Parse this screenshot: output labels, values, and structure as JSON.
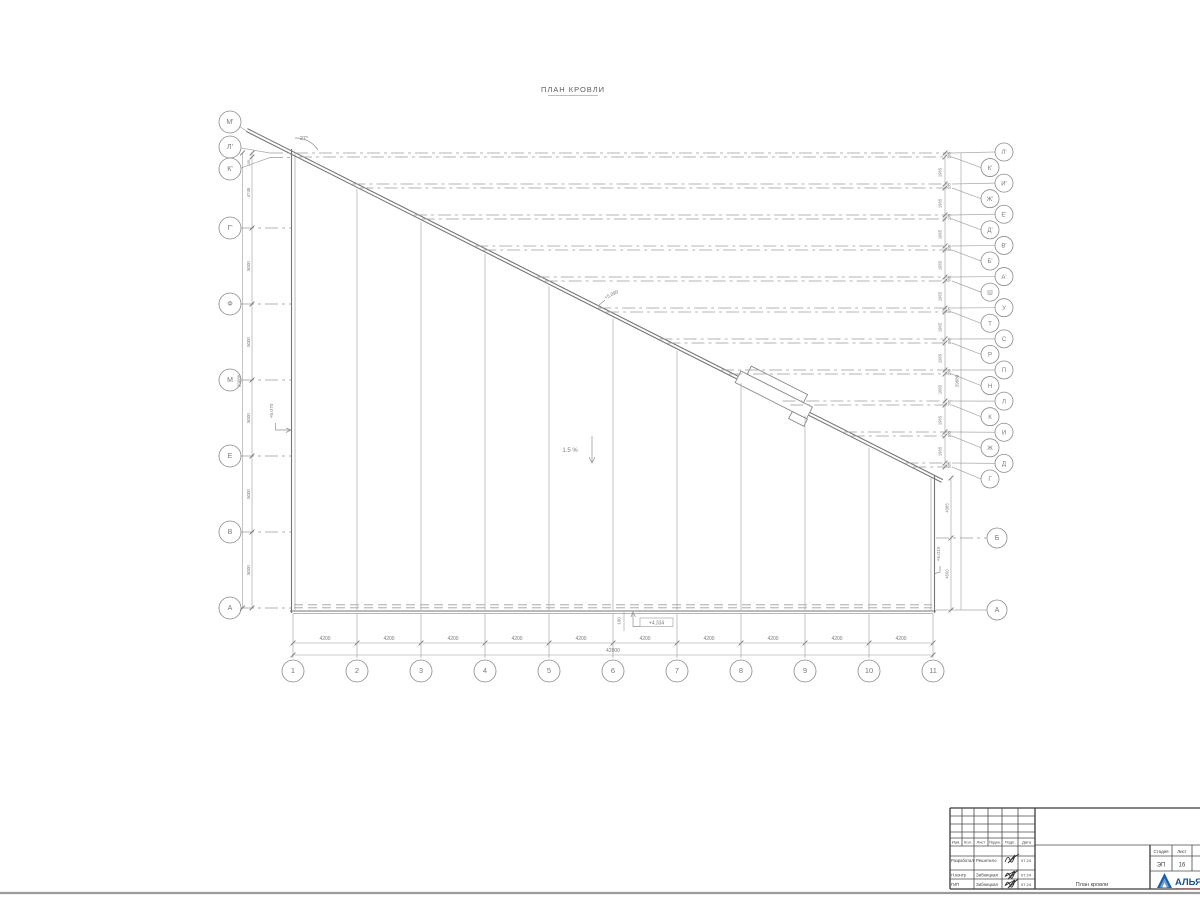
{
  "title": "ПЛАН КРОВЛИ",
  "annotations": {
    "angle": "27°",
    "slope": "1.5 %",
    "elev_slope": "+5.090",
    "elev_left": "+5.070",
    "elev_right": "+5.010",
    "elev_bottom": "+4.334",
    "offset_dim": "100"
  },
  "axes": {
    "bottom": {
      "labels": [
        "1",
        "2",
        "3",
        "4",
        "5",
        "6",
        "7",
        "8",
        "9",
        "10",
        "11"
      ],
      "segment_dim": "4200",
      "total_dim": "42000"
    },
    "left": {
      "labels": [
        "М'",
        "Л'",
        "К'",
        "Г'",
        "Ф",
        "М",
        "Е",
        "В",
        "А"
      ],
      "dims": [
        "195",
        "4745",
        "5000",
        "5000",
        "5000",
        "5000",
        "5000"
      ],
      "total_dim": "29680"
    },
    "right": {
      "labels": [
        "Л'",
        "К'",
        "И'",
        "Ж'",
        "Е'",
        "Д'",
        "В'",
        "Б'",
        "А'",
        "Ш",
        "У",
        "Т",
        "С",
        "Р",
        "П",
        "Н",
        "Л",
        "К",
        "И",
        "Ж",
        "Д",
        "Г"
      ],
      "pair_dim": "195",
      "segment_dim": "1965",
      "total_dim": "29680"
    },
    "right_bottom": {
      "labels": [
        "Б",
        "А"
      ],
      "dims": [
        "4385",
        "4500"
      ]
    }
  },
  "titleblock": {
    "header": [
      "Изм.",
      "Кол.",
      "Лист",
      "№док.",
      "Подп.",
      "Дата"
    ],
    "rows": [
      {
        "role": "Разработал",
        "name": "Решетило",
        "date": "07.24"
      },
      {
        "role": "Н.контр",
        "name": "Зибницкая",
        "date": "07.24"
      },
      {
        "role": "ГИП",
        "name": "Зибницкая",
        "date": "07.24"
      }
    ],
    "doc_title": "План кровли",
    "stage_label": "Стадия",
    "stage": "ЭП",
    "sheet_label": "Лист",
    "sheet": "16",
    "logo_text": "АЛЬЯ",
    "logo_sub": "строительная компания"
  },
  "colors": {
    "line": "#9b9b9b",
    "outline": "#767676",
    "text": "#7a7a7a",
    "block": "#3f3f3f",
    "logo_blue": "#1a5fa8",
    "logo_red": "#c0504d"
  }
}
